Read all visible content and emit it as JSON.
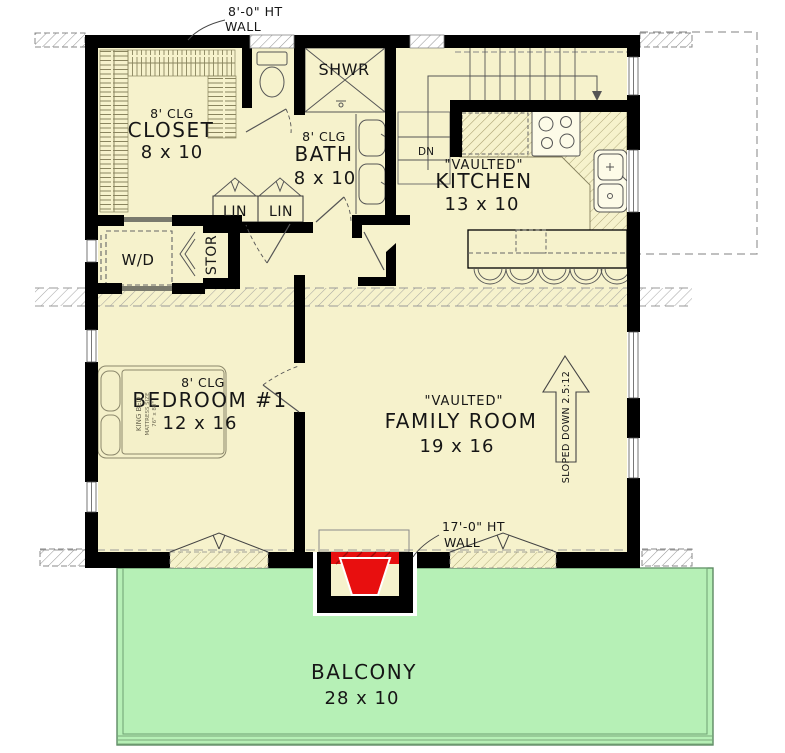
{
  "plan": {
    "title": "Upper floor plan",
    "wall_notes": {
      "top_line1": "8'-0\" HT",
      "top_line2": "WALL",
      "bottom_line1": "17'-0\" HT",
      "bottom_line2": "WALL"
    },
    "rooms": {
      "closet": {
        "ceiling": "8' CLG",
        "name": "CLOSET",
        "size": "8 x 10"
      },
      "bath": {
        "ceiling": "8' CLG",
        "name": "BATH",
        "size": "8 x 10"
      },
      "shower": {
        "name": "SHWR"
      },
      "kitchen": {
        "tag": "\"VAULTED\"",
        "name": "KITCHEN",
        "size": "13 x 10"
      },
      "bedroom1": {
        "ceiling": "8' CLG",
        "name": "BEDROOM #1",
        "size": "12 x 16"
      },
      "family_room": {
        "tag": "\"VAULTED\"",
        "name": "FAMILY ROOM",
        "size": "19 x 16"
      },
      "balcony": {
        "name": "BALCONY",
        "size": "28 x 10"
      }
    },
    "closets": {
      "linen1": "LIN",
      "linen2": "LIN",
      "storage": "STOR",
      "washer_dryer": "W/D"
    },
    "stairs": {
      "down_label": "DN"
    },
    "roof": {
      "slope_note": "SLOPED DOWN 2.5:12"
    },
    "furniture": {
      "bed_line1": "KING BED",
      "bed_line2": "MATTRESS SIZE",
      "bed_line3": "76\" x 80\""
    },
    "colors": {
      "floor": "#f6f2cc",
      "balcony": "#b6f0b6",
      "fireplace": "#e80f0f",
      "wall": "#000000",
      "counter_hatch": "#b3ab7c"
    }
  }
}
